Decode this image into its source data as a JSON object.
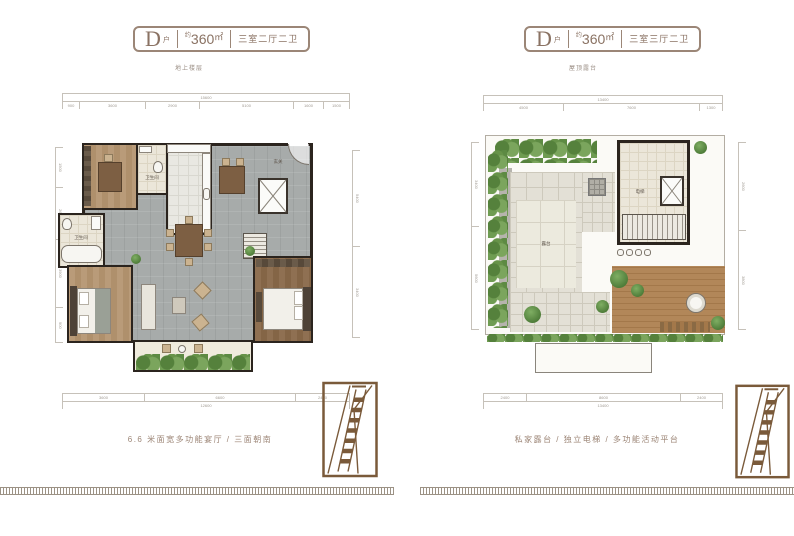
{
  "sheet": {
    "background": "#ffffff",
    "accent_brown": "#8a7263",
    "greenery_color": "#6f9e53",
    "wall_color": "#2b241e"
  },
  "left_panel": {
    "title": {
      "unit_letter": "D",
      "unit_suffix": "户",
      "approx_label": "约",
      "area_number": "360",
      "area_unit": "㎡",
      "layout": "三室二厅二卫"
    },
    "subtitle": "地上楼层",
    "caption": "6.6 米面宽多功能宴厅 / 三面朝南",
    "room_labels": {
      "bathroom_top": "卫生间",
      "bathroom_left": "卫生间",
      "entry": "玄关"
    },
    "dimensions": {
      "top_total": "15600",
      "top_segments": [
        "900",
        "3600",
        "2900",
        "5100",
        "1600",
        "1500"
      ],
      "bottom_total": "12600",
      "bottom_segments": [
        "3600",
        "6600",
        "2400"
      ],
      "left_segments": [
        "1500",
        "2600",
        "3900",
        "900"
      ],
      "right_segments": [
        "5400",
        "3400"
      ]
    }
  },
  "right_panel": {
    "title": {
      "unit_letter": "D",
      "unit_suffix": "户",
      "approx_label": "约",
      "area_number": "360",
      "area_unit": "㎡",
      "layout": "三室三厅二卫"
    },
    "subtitle": "屋顶露台",
    "caption": "私家露台 / 独立电梯 / 多功能活动平台",
    "room_labels": {
      "terrace": "露台",
      "elevator": "电梯"
    },
    "dimensions": {
      "top_total": "13400",
      "top_segments": [
        "4500",
        "7600",
        "1300"
      ],
      "bottom_total": "13400",
      "bottom_segments": [
        "2400",
        "8600",
        "2400"
      ],
      "left_segments": [
        "3400",
        "5600"
      ],
      "right_segments": [
        "2600",
        "3800"
      ]
    }
  }
}
